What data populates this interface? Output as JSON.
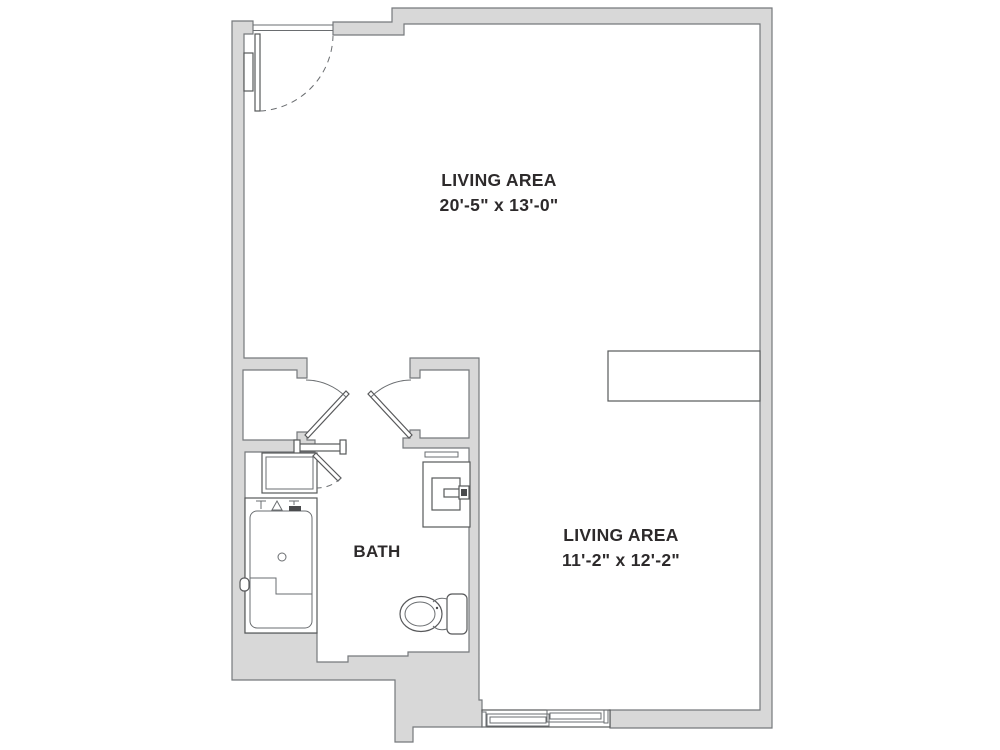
{
  "floor_plan": {
    "type": "studio-apartment-floor-plan",
    "rooms": {
      "living_area_1": {
        "label": "LIVING AREA",
        "dims": "20'-5\" x 13'-0\""
      },
      "living_area_2": {
        "label": "LIVING AREA",
        "dims": "11'-2\" x 12'-2\""
      },
      "bath": {
        "label": "BATH"
      }
    },
    "fixtures": [
      "entry-door",
      "entry-swing-arc",
      "wall-shelf",
      "closet-left",
      "closet-left-door",
      "closet-right",
      "closet-right-door",
      "bath-sliding-door",
      "linen-cabinet",
      "linen-cabinet-door",
      "roll-in-shower",
      "shower-bench",
      "shower-drain",
      "shower-valves",
      "wall-sink",
      "sink-faucet",
      "toilet",
      "sliding-window",
      "counter-partition"
    ],
    "colors": {
      "background": "#ffffff",
      "wall_fill": "#d8d8d8",
      "wall_stroke": "#76797c",
      "fixture_stroke": "#58595b",
      "text": "#2d2a2b"
    }
  }
}
